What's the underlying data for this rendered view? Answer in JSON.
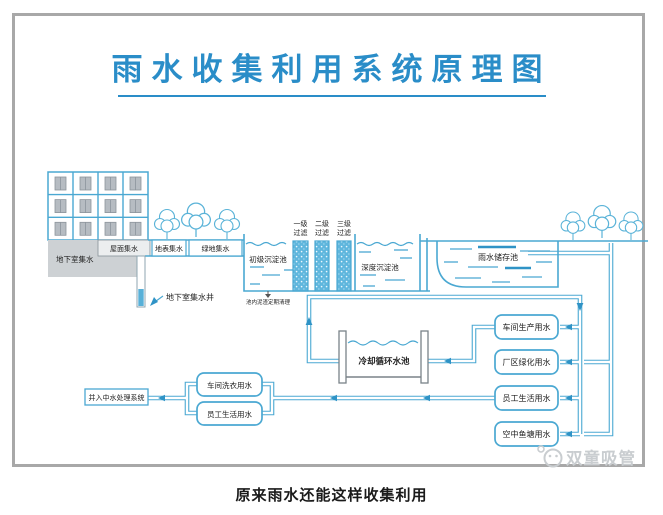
{
  "title": "雨水收集利用系统原理图",
  "caption": "原来雨水还能这样收集利用",
  "watermark": "双童吸管",
  "colors": {
    "title_blue": "#2a8dc8",
    "line_blue": "#4aa8d2",
    "arrow_blue": "#2f93c6",
    "frame_gray": "#a8a8a8",
    "basement_gray": "#cdd1d4"
  },
  "labels": {
    "roof_collect": "屋面集水",
    "basement_collect": "地下室集水",
    "surface_collect": "地表集水",
    "green_collect": "绿地集水",
    "basement_well": "地下室集水井",
    "primary_tank": "初级沉淀池",
    "deep_tank": "深度沉淀池",
    "storage_pool": "雨水储存池",
    "cooling_pool": "冷却循环水池",
    "sludge_note": "池内泥渣定期清理",
    "treatment": "并入中水处理系统"
  },
  "filters": [
    {
      "top": "一级",
      "bottom": "过滤"
    },
    {
      "top": "二级",
      "bottom": "过滤"
    },
    {
      "top": "三级",
      "bottom": "过滤"
    }
  ],
  "usage_right": [
    "车间生产用水",
    "厂区绿化用水",
    "员工生活用水",
    "空中鱼塘用水"
  ],
  "usage_left": [
    "车间洗衣用水",
    "员工生活用水"
  ]
}
